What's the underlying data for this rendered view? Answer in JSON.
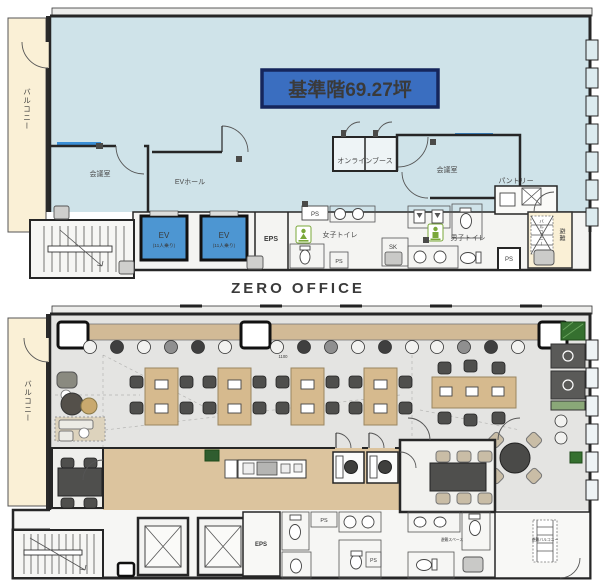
{
  "watermark": "ZERO OFFICE",
  "top_plan": {
    "title": "基準階69.27坪",
    "balcony": "バルコニー",
    "meeting_room_left": "会議室",
    "ev_hall": "EVホール",
    "online_booth": "オンラインブース",
    "meeting_room_right": "会議室",
    "pantry": "パントリー",
    "ev": "EV",
    "ev_capacity": "(11人乗り)",
    "eps": "EPS",
    "ps": "PS",
    "womens_toilet": "女子トイレ",
    "sk": "SK",
    "mens_toilet": "男子トイレ",
    "evac_balcony_vert": "バルコニー",
    "evac_vert": "避難"
  },
  "bottom_plan": {
    "balcony": "バルコニー",
    "eps": "EPS",
    "ps": "PS",
    "dim_1100": "1100",
    "evac_space": "避難スペース",
    "evac_balcony": "避難バルコニー"
  },
  "colors": {
    "floor_blue": "#cfe3e9",
    "floor_gray": "#e4e4e2",
    "balcony_cream": "#faf0d6",
    "ev_blue": "#4d96d2",
    "title_bg": "#3a6ec0",
    "title_border": "#15265c",
    "desk_wood": "#d6ba8e",
    "corridor_wood": "#dcc49e",
    "chair_dark": "#4f4f4d",
    "chair_beige": "#c9bda6",
    "plant_green": "#35702f",
    "window_blue": "#3a8fd6"
  }
}
